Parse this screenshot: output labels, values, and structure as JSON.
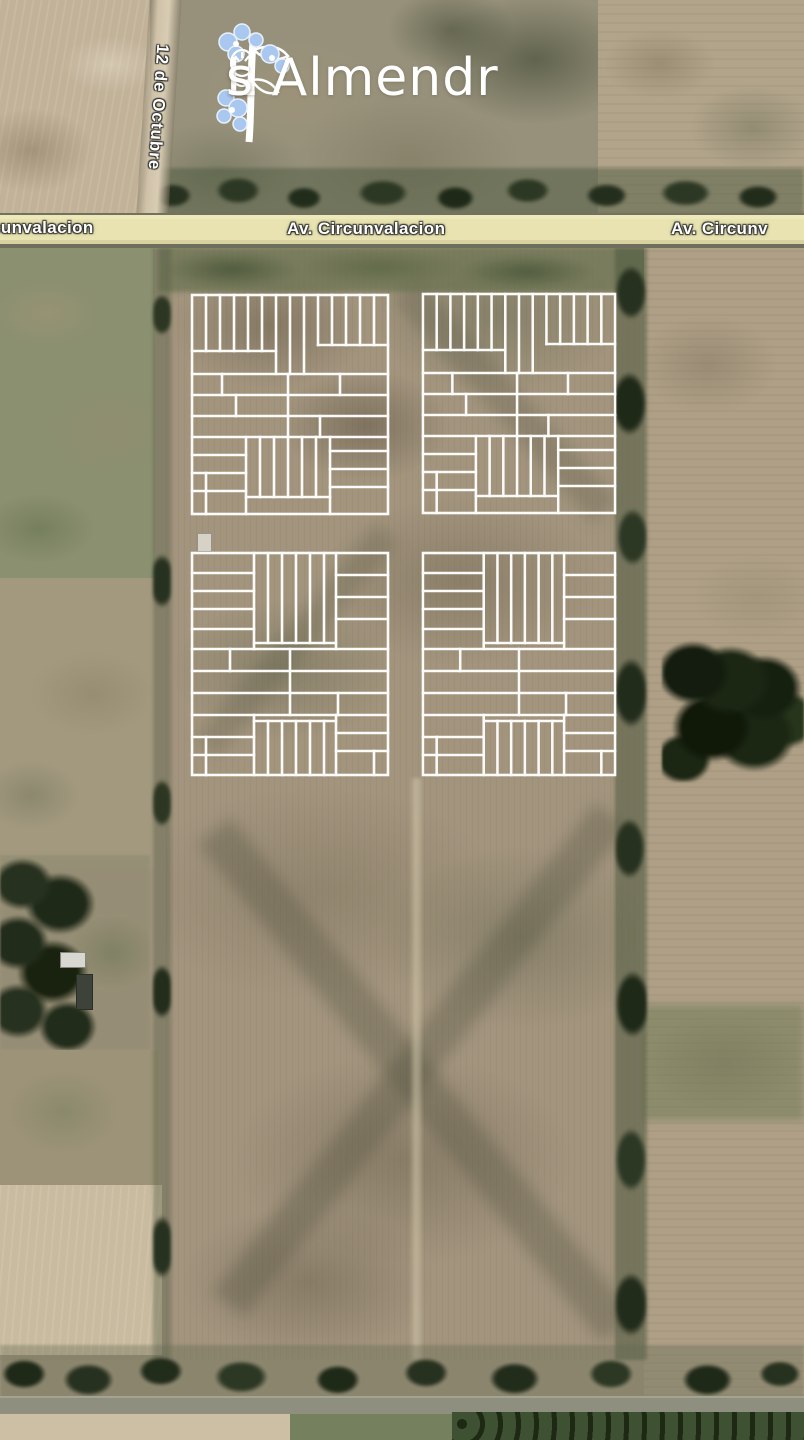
{
  "map_title": "Los Almendros development plan over satellite imagery",
  "logo": {
    "name": "Los Almendros",
    "parts": [
      "L",
      "s Almendr",
      "s"
    ]
  },
  "roads": {
    "av_label_left": "cunvalacion",
    "av_label_center": "Av. Circunvalacion",
    "av_label_right": "Av. Circunv",
    "cross_street": "12 de Octubre"
  },
  "blocks": [
    {
      "id": "block-1",
      "type": "A"
    },
    {
      "id": "block-2",
      "type": "A"
    },
    {
      "id": "block-3",
      "type": "B"
    },
    {
      "id": "block-4",
      "type": "B"
    }
  ],
  "palette": {
    "lot_line": "#ffffff",
    "road_fill": "#e8e3b0",
    "road_casing": "#75715f",
    "dirt_road": "#cfc2a9",
    "tree_dark": "#27311f",
    "field_tan": "#a3967f",
    "field_pale": "#c1b298",
    "pasture_green": "#8b9070",
    "label_text": "#ffffff",
    "logo_flower_blue": "#a9c7ef"
  }
}
